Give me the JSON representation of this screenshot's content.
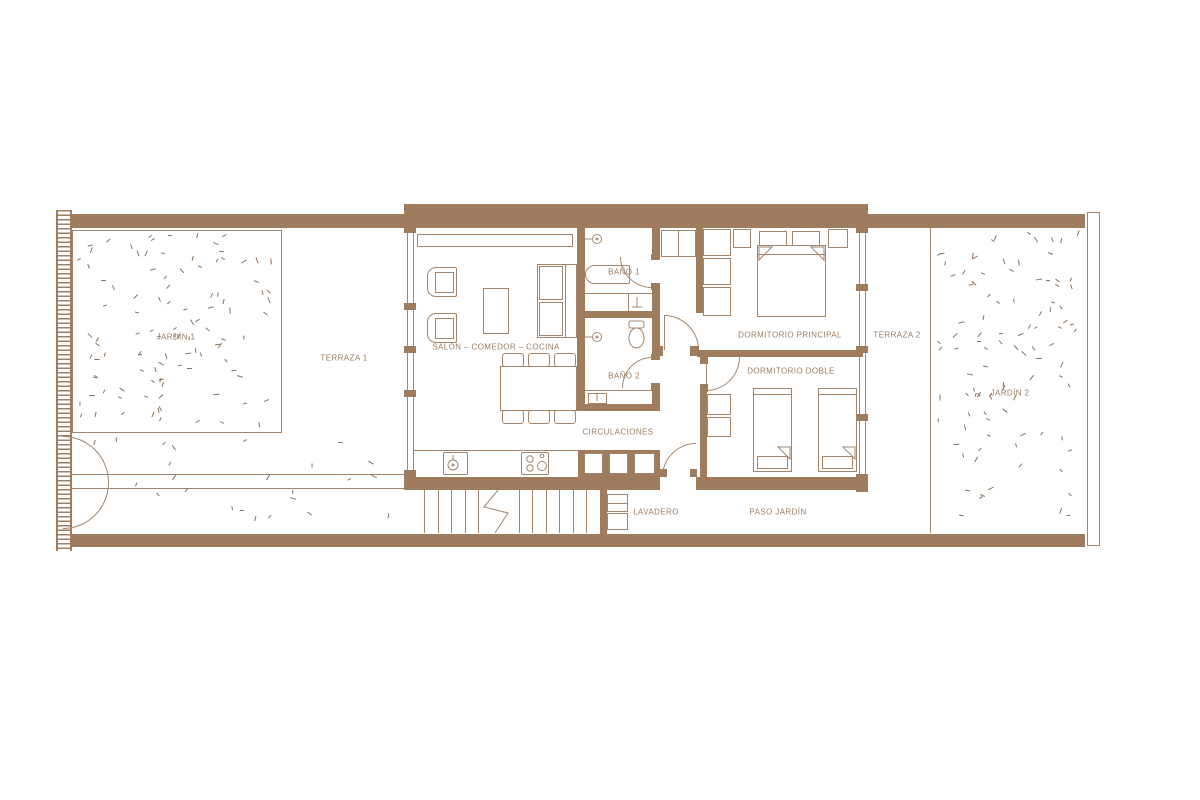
{
  "plan": {
    "title": "floor-plan",
    "labels": {
      "jardin1": "JARDÍN 1",
      "terraza1": "TERRAZA 1",
      "salon": "SALÓN – COMEDOR – COCINA",
      "bano1": "BAÑO 1",
      "bano2": "BAÑO 2",
      "circulaciones": "CIRCULACIONES",
      "dormitorio_principal": "DORMITORIO PRINCIPAL",
      "dormitorio_doble": "DORMITORIO DOBLE",
      "terraza2": "TERRAZA 2",
      "jardin2": "JARDÍN 2",
      "lavadero": "LAVADERO",
      "paso_jardin": "PASO JARDÍN"
    },
    "colors": {
      "wall": "#a07c5f",
      "line": "#a5846c",
      "text": "#9d7b60",
      "grass_tick": "#8d7058",
      "background": "#ffffff"
    },
    "icons": {
      "shower-icon": "circle-with-stem",
      "bathtub-icon": "rounded-rect",
      "toilet-icon": "ellipse",
      "sink-icon": "square-with-circle",
      "stove-icon": "square-with-burners",
      "stairs-icon": "parallel-lines-with-break",
      "double-bed-icon": "rect-with-pillows",
      "single-bed-icon": "rect-with-pillow",
      "sofa-icon": "rect-with-cushions",
      "armchair-icon": "rounded-rect-seat",
      "dining-table-icon": "rect-with-chairs",
      "washer-icon": "stacked-squares",
      "door-swing-icon": "quarter-arc",
      "gate-icon": "semicircle-arc",
      "grass-icon": "random-dashes"
    }
  }
}
